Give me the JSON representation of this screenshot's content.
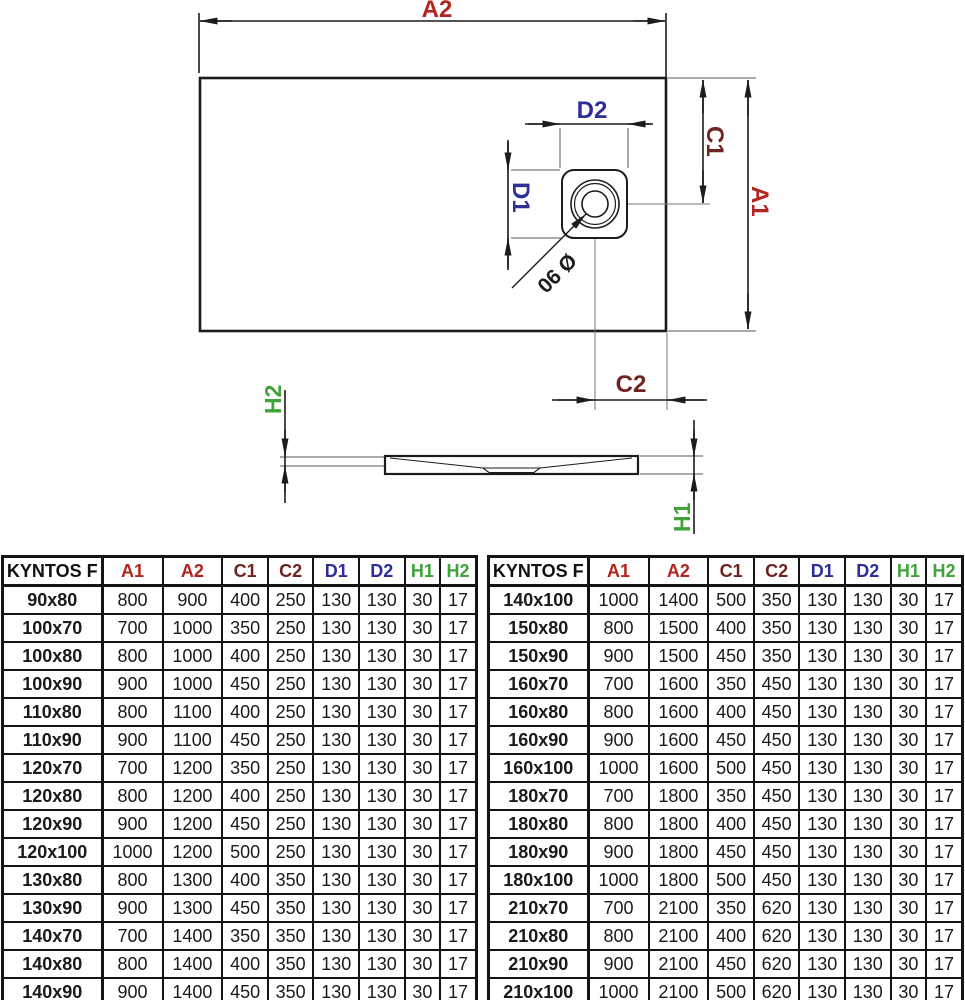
{
  "diagram": {
    "labels": {
      "a2": "A2",
      "a1": "A1",
      "c1": "C1",
      "c2": "C2",
      "d1": "D1",
      "d2": "D2",
      "h1": "H1",
      "h2": "H2",
      "drain_diameter": "Ø 90"
    },
    "colors": {
      "a_dimension": "#b3241e",
      "c_dimension": "#6f2320",
      "d_dimension": "#2e2e96",
      "h_dimension": "#3fa33a",
      "drawing_line": "#1c1c1c",
      "extension_line": "#8d8d8d"
    }
  },
  "tables": {
    "title": "KYNTOS F",
    "header": [
      "KYNTOS F",
      "A1",
      "A2",
      "C1",
      "C2",
      "D1",
      "D2",
      "H1",
      "H2"
    ],
    "header_colors": [
      "#111111",
      "#b3241e",
      "#b3241e",
      "#6f2320",
      "#6f2320",
      "#2e2e96",
      "#2e2e96",
      "#3fa33a",
      "#3fa33a"
    ],
    "left": [
      {
        "model": "90x80",
        "values": [
          800,
          900,
          400,
          250,
          130,
          130,
          30,
          17
        ]
      },
      {
        "model": "100x70",
        "values": [
          700,
          1000,
          350,
          250,
          130,
          130,
          30,
          17
        ]
      },
      {
        "model": "100x80",
        "values": [
          800,
          1000,
          400,
          250,
          130,
          130,
          30,
          17
        ]
      },
      {
        "model": "100x90",
        "values": [
          900,
          1000,
          450,
          250,
          130,
          130,
          30,
          17
        ]
      },
      {
        "model": "110x80",
        "values": [
          800,
          1100,
          400,
          250,
          130,
          130,
          30,
          17
        ]
      },
      {
        "model": "110x90",
        "values": [
          900,
          1100,
          450,
          250,
          130,
          130,
          30,
          17
        ]
      },
      {
        "model": "120x70",
        "values": [
          700,
          1200,
          350,
          250,
          130,
          130,
          30,
          17
        ]
      },
      {
        "model": "120x80",
        "values": [
          800,
          1200,
          400,
          250,
          130,
          130,
          30,
          17
        ]
      },
      {
        "model": "120x90",
        "values": [
          900,
          1200,
          450,
          250,
          130,
          130,
          30,
          17
        ]
      },
      {
        "model": "120x100",
        "values": [
          1000,
          1200,
          500,
          250,
          130,
          130,
          30,
          17
        ]
      },
      {
        "model": "130x80",
        "values": [
          800,
          1300,
          400,
          350,
          130,
          130,
          30,
          17
        ]
      },
      {
        "model": "130x90",
        "values": [
          900,
          1300,
          450,
          350,
          130,
          130,
          30,
          17
        ]
      },
      {
        "model": "140x70",
        "values": [
          700,
          1400,
          350,
          350,
          130,
          130,
          30,
          17
        ]
      },
      {
        "model": "140x80",
        "values": [
          800,
          1400,
          400,
          350,
          130,
          130,
          30,
          17
        ]
      },
      {
        "model": "140x90",
        "values": [
          900,
          1400,
          450,
          350,
          130,
          130,
          30,
          17
        ]
      }
    ],
    "right": [
      {
        "model": "140x100",
        "values": [
          1000,
          1400,
          500,
          350,
          130,
          130,
          30,
          17
        ]
      },
      {
        "model": "150x80",
        "values": [
          800,
          1500,
          400,
          350,
          130,
          130,
          30,
          17
        ]
      },
      {
        "model": "150x90",
        "values": [
          900,
          1500,
          450,
          350,
          130,
          130,
          30,
          17
        ]
      },
      {
        "model": "160x70",
        "values": [
          700,
          1600,
          350,
          450,
          130,
          130,
          30,
          17
        ]
      },
      {
        "model": "160x80",
        "values": [
          800,
          1600,
          400,
          450,
          130,
          130,
          30,
          17
        ]
      },
      {
        "model": "160x90",
        "values": [
          900,
          1600,
          450,
          450,
          130,
          130,
          30,
          17
        ]
      },
      {
        "model": "160x100",
        "values": [
          1000,
          1600,
          500,
          450,
          130,
          130,
          30,
          17
        ]
      },
      {
        "model": "180x70",
        "values": [
          700,
          1800,
          350,
          450,
          130,
          130,
          30,
          17
        ]
      },
      {
        "model": "180x80",
        "values": [
          800,
          1800,
          400,
          450,
          130,
          130,
          30,
          17
        ]
      },
      {
        "model": "180x90",
        "values": [
          900,
          1800,
          450,
          450,
          130,
          130,
          30,
          17
        ]
      },
      {
        "model": "180x100",
        "values": [
          1000,
          1800,
          500,
          450,
          130,
          130,
          30,
          17
        ]
      },
      {
        "model": "210x70",
        "values": [
          700,
          2100,
          350,
          620,
          130,
          130,
          30,
          17
        ]
      },
      {
        "model": "210x80",
        "values": [
          800,
          2100,
          400,
          620,
          130,
          130,
          30,
          17
        ]
      },
      {
        "model": "210x90",
        "values": [
          900,
          2100,
          450,
          620,
          130,
          130,
          30,
          17
        ]
      },
      {
        "model": "210x100",
        "values": [
          1000,
          2100,
          500,
          620,
          130,
          130,
          30,
          17
        ]
      }
    ]
  }
}
